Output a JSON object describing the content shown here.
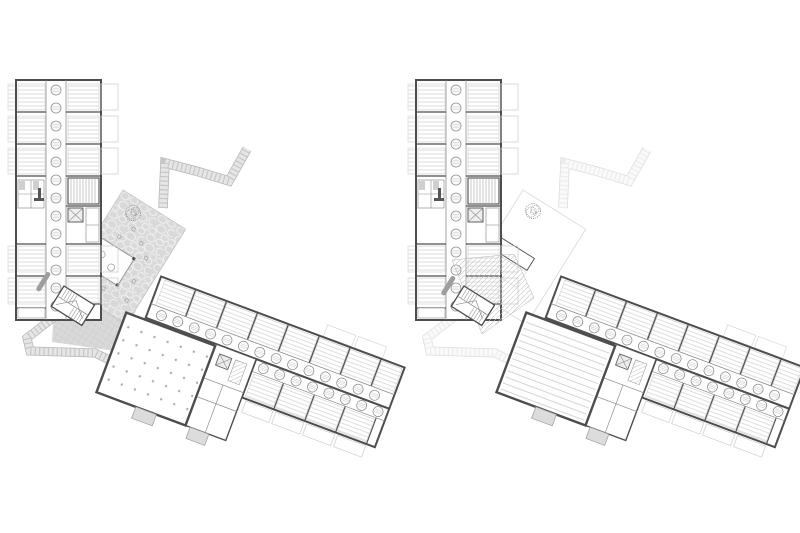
{
  "canvas": {
    "width": 800,
    "height": 533,
    "background": "#ffffff"
  },
  "drawing": {
    "type": "architectural-floor-plan-pair",
    "description": "Two floor plans of an angled building drawn side by side: the left plan shows the ground floor with a flagstone courtyard, glazed pavilion, entrance hall and a large hall with a column grid; the right plan shows the upper floor with the courtyard in outline, an atrium void and the hall roof drawn as parallel lines.",
    "plans": [
      {
        "id": "plan-left",
        "side": "left",
        "features": [
          "north-room-wing",
          "corridor-rooflights",
          "paved-courtyard",
          "courtyard-tree",
          "glazed-pavilion",
          "courtyard-tables",
          "entrance-hall-tiles",
          "main-stair",
          "reception-desk",
          "upper-footpath",
          "entry-ramp",
          "diagonal-room-wing",
          "event-hall-column-grid",
          "balconies",
          "service-core",
          "exterior-stair"
        ]
      },
      {
        "id": "plan-right",
        "side": "right",
        "features": [
          "north-room-wing",
          "corridor-rooflights",
          "courtyard-outline",
          "courtyard-tree",
          "room-over-pavilion",
          "atrium-void-hatch",
          "main-stair",
          "upper-footpath-faint",
          "entry-ramp-faint",
          "diagonal-room-wing",
          "event-hall-roof-lines",
          "balconies",
          "service-core",
          "exterior-stair"
        ]
      }
    ],
    "rooflight_counts": {
      "north_wing": 13,
      "diagonal_wing_row1": 14,
      "diagonal_wing_row2": 8
    }
  },
  "colors": {
    "wall": "#4d4d4d",
    "partition": "#8f8f8f",
    "light_line": "#c8c8c8",
    "room_stripe": "#dedede",
    "balcony": "#d2d2d2",
    "paving": "#d9d9d9",
    "paving_joint": "#f1f1f1",
    "tile_line": "#c2c2c2",
    "path_edge": "#b5b5b5",
    "path_fill": "#e6e6e6",
    "tread": "#c6c6c6",
    "dot": "#ababab",
    "roofline": "#c9c9c9",
    "hatch": "#c4c4c4",
    "desk": "#9e9e9e",
    "stair": "#9b9b9b",
    "faint": "#dcdcdc",
    "fixture": "#565656"
  }
}
